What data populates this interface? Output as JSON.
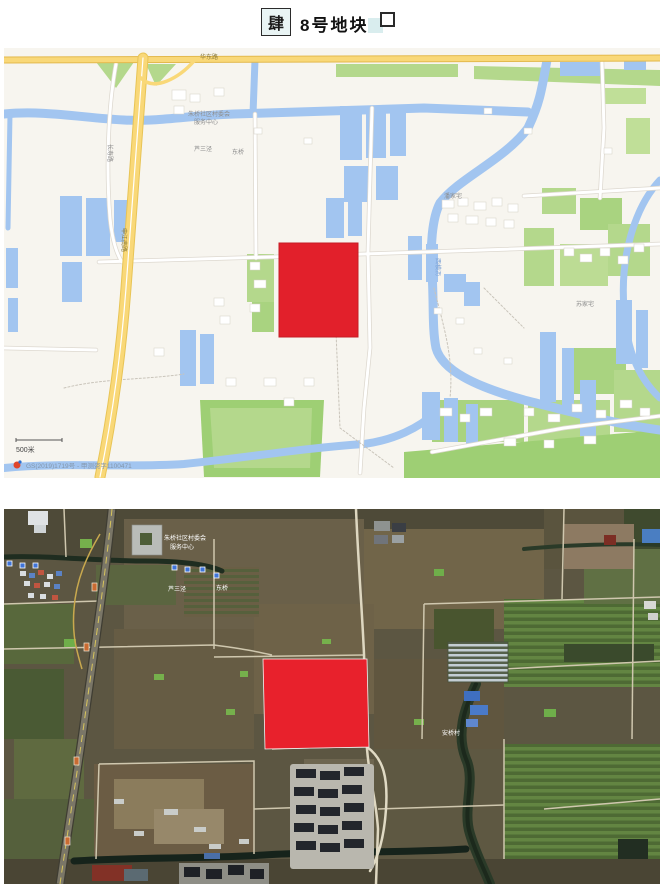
{
  "header": {
    "section_marker": "肆",
    "title": "8号地块",
    "square_glyph": "□"
  },
  "street_map": {
    "plot_color": "#e2202b",
    "labels": {
      "top_road": "华东路",
      "expressway": "申江南路",
      "poi_line1": "朱桥社区村委会",
      "poi_line2": "服务中心",
      "road_vertical": "长寿路",
      "village_a": "芦三泾",
      "village_b": "东桥",
      "village_c": "潘家宅",
      "village_d": "苏家宅",
      "water_name": "西横沥"
    },
    "scale_label": "500米",
    "attribution_logo": "Baidu",
    "attribution": "GS(2019)1719号 - 甲测资字1100471"
  },
  "satellite_map": {
    "plot_color": "#e8212c",
    "labels": {
      "poi_line1": "朱桥社区村委会",
      "poi_line2": "服务中心",
      "village_a": "芦三泾",
      "village_b": "东桥",
      "village_c": "安桥村"
    }
  }
}
